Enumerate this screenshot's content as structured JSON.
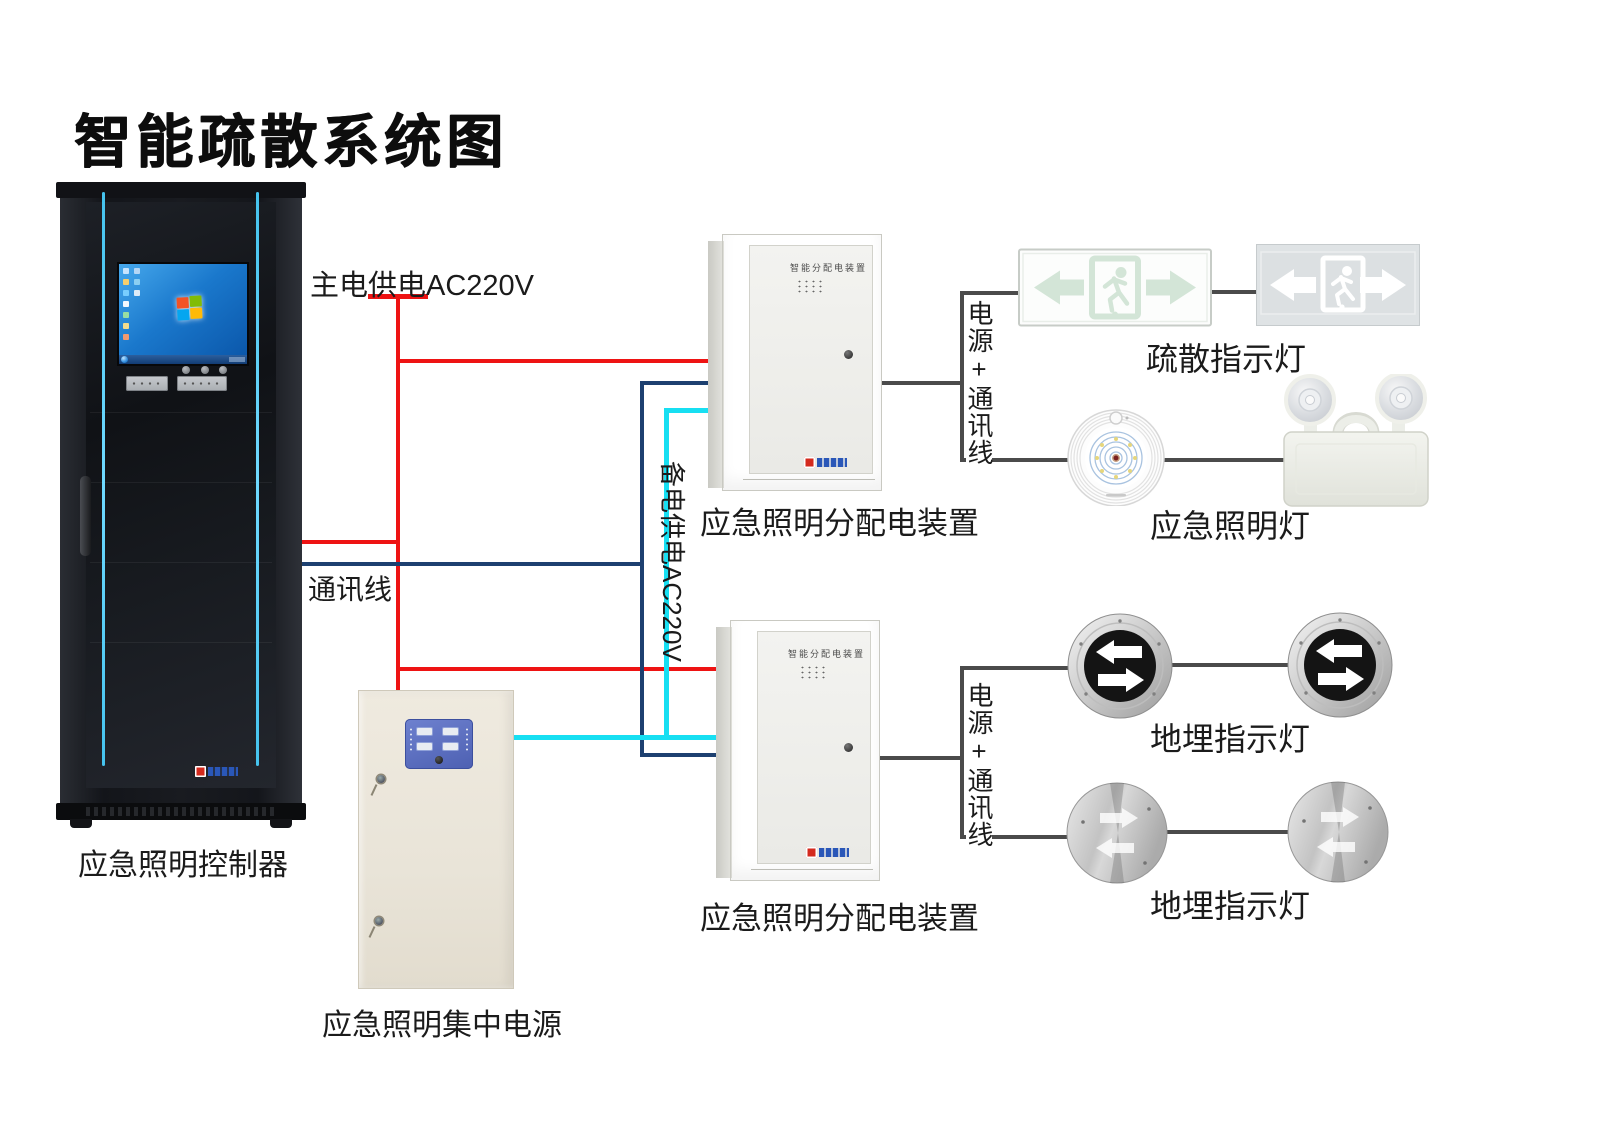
{
  "title": "智能疏散系统图",
  "controller": {
    "label": "应急照明控制器"
  },
  "power_supply": {
    "label": "应急照明集中电源"
  },
  "dist_boxes": [
    {
      "label": "应急照明分配电装置",
      "panel_text": "智能分配电装置"
    },
    {
      "label": "应急照明分配电装置",
      "panel_text": "智能分配电装置"
    }
  ],
  "wire_labels": {
    "main_power": "主电供电AC220V",
    "comm_line": "通讯线",
    "backup_power": "备电供电AC220V",
    "power_comm_top": "电源+通讯线",
    "power_comm_bottom": "电源+通讯线"
  },
  "device_labels": {
    "exit_signs": "疏散指示灯",
    "emergency_lights": "应急照明灯",
    "ground_lights_top": "地埋指示灯",
    "ground_lights_bottom": "地埋指示灯"
  },
  "colors": {
    "main_power_wire": "#ee1313",
    "comm_wire": "#1d4070",
    "backup_power_wire": "#17dff2",
    "connector_wire": "#4b4b4b",
    "cabinet_accent": "#45c3ee"
  }
}
